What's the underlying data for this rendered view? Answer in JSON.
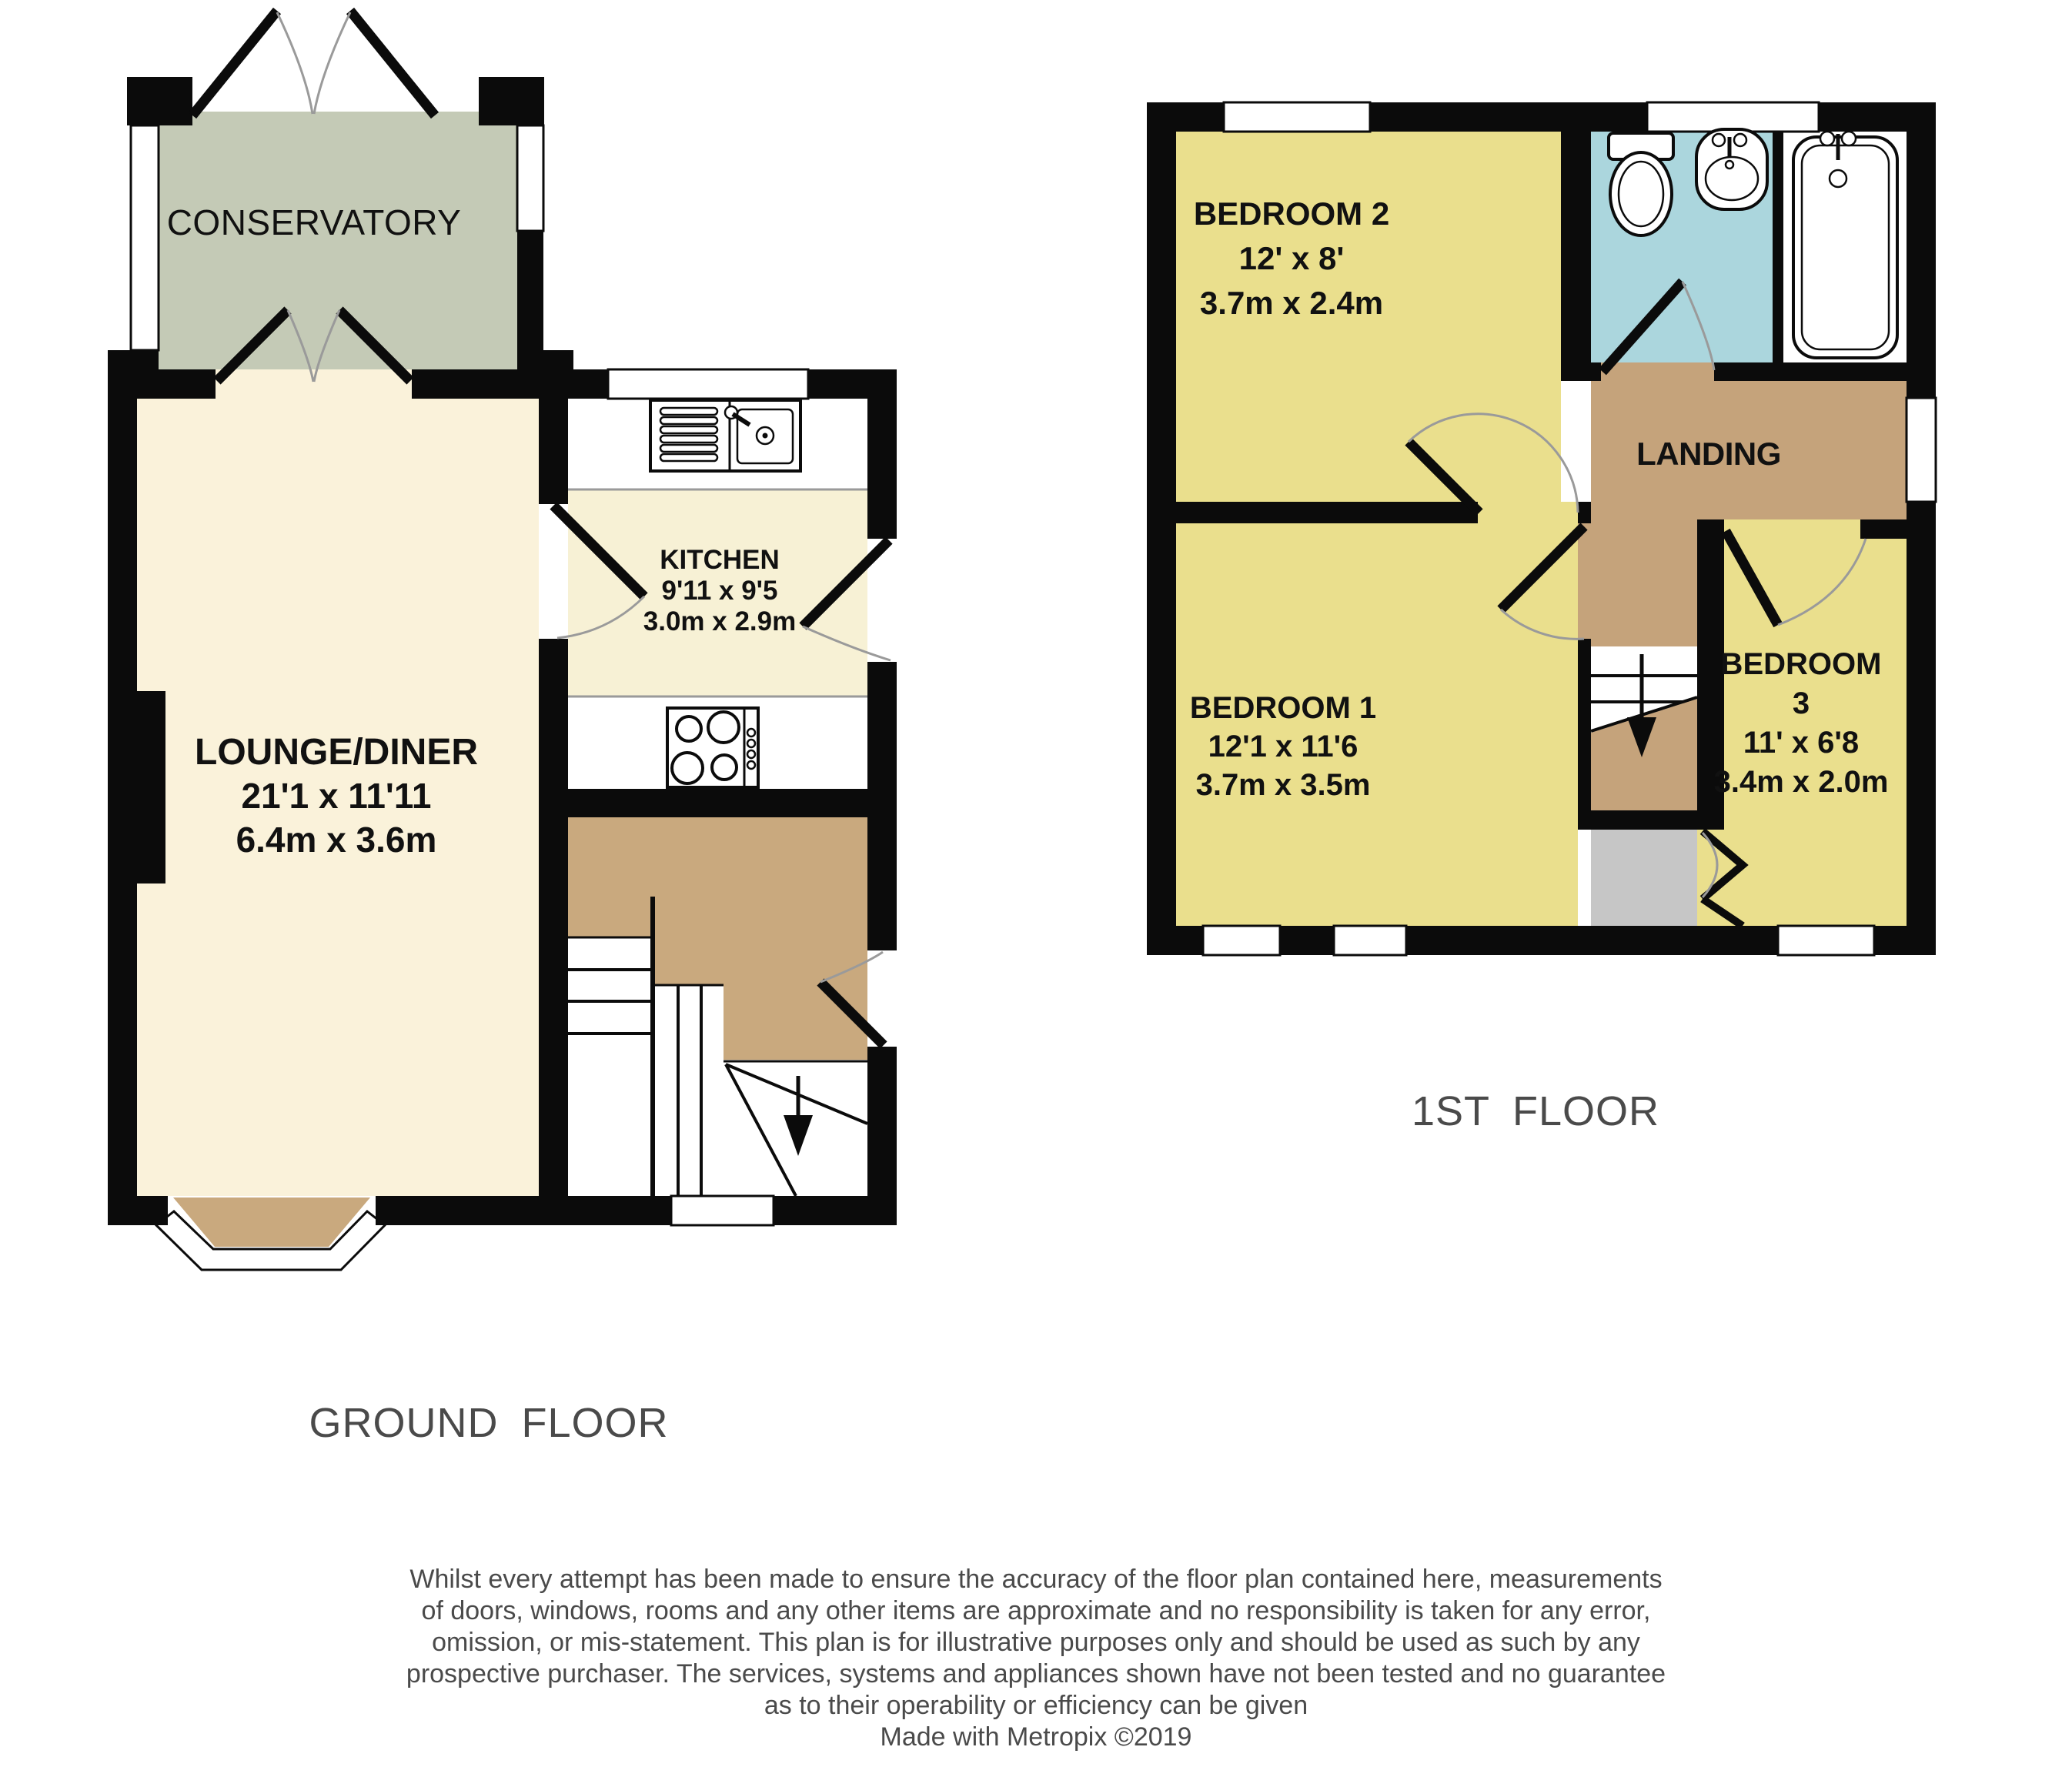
{
  "colors": {
    "wall": "#0b0b0b",
    "lounge": "#faf2da",
    "kitchen": "#f7f1d5",
    "hall": "#c9a97e",
    "landing": "#c5a37b",
    "bedroom": "#eadf8d",
    "bathroom": "#abd6dd",
    "conservatory": "#c4cab6",
    "cupboard": "#c6c6c6",
    "label": "#111111",
    "muted": "#4a4a4a",
    "arc": "#9a9a9a"
  },
  "ground_floor": {
    "label": "GROUND FLOOR",
    "conservatory": {
      "name": "CONSERVATORY"
    },
    "lounge": {
      "name": "LOUNGE/DINER",
      "imperial": "21'1 x 11'11",
      "metric": "6.4m x 3.6m"
    },
    "kitchen": {
      "name": "KITCHEN",
      "imperial": "9'11 x 9'5",
      "metric": "3.0m x 2.9m"
    }
  },
  "first_floor": {
    "label": "1ST FLOOR",
    "bedroom2": {
      "name": "BEDROOM 2",
      "imperial": "12' x 8'",
      "metric": "3.7m x 2.4m"
    },
    "bedroom1": {
      "name": "BEDROOM 1",
      "imperial": "12'1 x 11'6",
      "metric": "3.7m x 3.5m"
    },
    "bedroom3": {
      "name": "BEDROOM",
      "number": "3",
      "imperial": "11' x 6'8",
      "metric": "3.4m x 2.0m"
    },
    "landing": {
      "name": "LANDING"
    }
  },
  "disclaimer": {
    "lines": [
      "Whilst every attempt has been made to ensure the accuracy of the floor plan contained here, measurements",
      "of doors, windows, rooms and any other items are approximate and no responsibility is taken for any error,",
      "omission, or mis-statement. This plan is for illustrative purposes only and should be used as such by any",
      "prospective purchaser. The services, systems and appliances shown have not been tested and no guarantee",
      "as to their operability or efficiency can be given",
      "Made with Metropix ©2019"
    ]
  }
}
